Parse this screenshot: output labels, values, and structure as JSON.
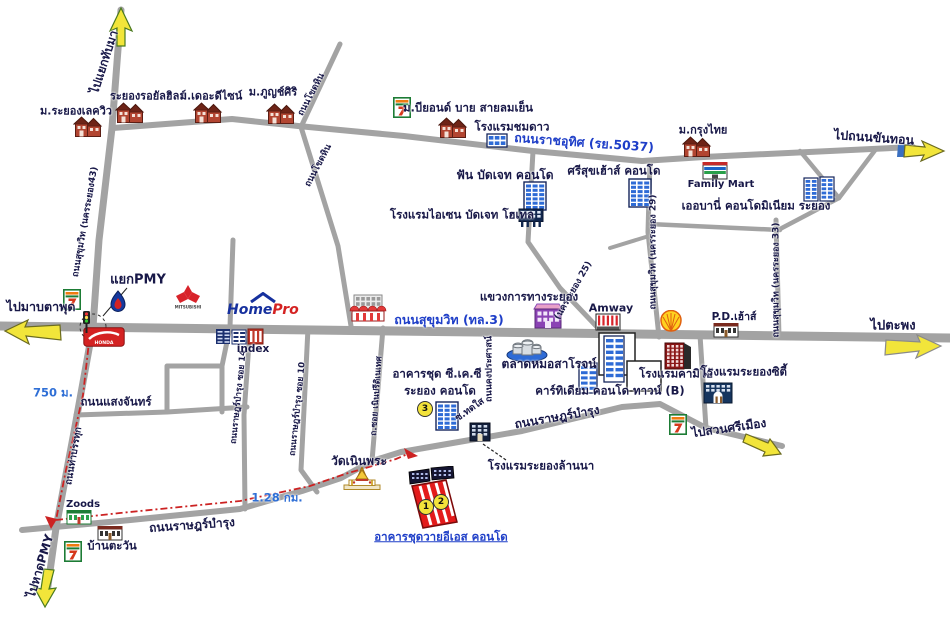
{
  "colors": {
    "dark": "#181848",
    "blue": "#1e3ec8",
    "dist": "#2f6fd6",
    "road": "#a3a3a3",
    "route_red": "#cc2222",
    "arrow_yellow": "#f2e53a"
  },
  "map": {
    "homepro": {
      "home": "Home",
      "pro": "Pro"
    },
    "labels": [
      {
        "id": "to-thapma",
        "text": "ไปแยกทับมา",
        "x": 104,
        "y": 62,
        "rot": -72,
        "size": 12
      },
      {
        "id": "lakeview",
        "text": "ม.ระยองเลควิว",
        "x": 76,
        "y": 111,
        "size": 11
      },
      {
        "id": "royal-hills",
        "text": "ระยองรอยัลฮิลส์",
        "x": 148,
        "y": 96,
        "size": 11
      },
      {
        "id": "the-design",
        "text": "ม.เดอะดีไซน์",
        "x": 211,
        "y": 96,
        "size": 11
      },
      {
        "id": "phuchsiri",
        "text": "ม.ภูญช์ศิริ",
        "x": 273,
        "y": 92,
        "size": 11
      },
      {
        "id": "khothin-upper",
        "text": "ถนนโขดหิน",
        "x": 312,
        "y": 95,
        "rot": -62,
        "size": 9
      },
      {
        "id": "khothin-lower",
        "text": "ถนนโขดหิน",
        "x": 319,
        "y": 166,
        "rot": -62,
        "size": 9
      },
      {
        "id": "beyond",
        "text": "ม.บียอนด์ บาย สายลมเย็น",
        "x": 468,
        "y": 108,
        "size": 11.5
      },
      {
        "id": "chomdao",
        "text": "โรงแรมชมดาว",
        "x": 512,
        "y": 127,
        "size": 11.5
      },
      {
        "id": "ratcha-uthit",
        "text": "ถนนราชอุทิศ (รย.5037)",
        "x": 584,
        "y": 143,
        "rot": 4,
        "size": 12.5,
        "color": "blue"
      },
      {
        "id": "fun-budget",
        "text": "ฟัน บัดเจท คอนโด",
        "x": 505,
        "y": 175,
        "size": 12
      },
      {
        "id": "aisen",
        "text": "โรงแรมไอเซน บัดเจท โฮเทล",
        "x": 462,
        "y": 215,
        "size": 11.5
      },
      {
        "id": "srisuk",
        "text": "ศรีสุขเฮ้าส์ คอนโด",
        "x": 614,
        "y": 171,
        "size": 11.5
      },
      {
        "id": "krungthai",
        "text": "ม.กรุงไทย",
        "x": 703,
        "y": 130,
        "size": 11
      },
      {
        "id": "familymart",
        "text": "Family Mart",
        "x": 721,
        "y": 185,
        "size": 10
      },
      {
        "id": "urbani",
        "text": "เออบานี่ คอนโดมิเนียม ระยอง",
        "x": 756,
        "y": 206,
        "size": 11.5
      },
      {
        "id": "to-khanthon",
        "text": "ไปถนนขันทอน",
        "x": 874,
        "y": 138,
        "rot": 4,
        "size": 12.5
      },
      {
        "id": "nakhon29",
        "text": "ถนนสุขุมวิท (นครระยอง 29)",
        "x": 654,
        "y": 252,
        "rot": -90,
        "size": 9
      },
      {
        "id": "nakhon33",
        "text": "ถนนสุขุมวิท (นครระยอง 33)",
        "x": 777,
        "y": 280,
        "rot": -90,
        "size": 9
      },
      {
        "id": "nakhon43",
        "text": "ถนนสุขุมวิท (นครระยอง43)",
        "x": 86,
        "y": 222,
        "rot": -80,
        "size": 9
      },
      {
        "id": "nakhon25",
        "text": "(นครระยอง 25)",
        "x": 574,
        "y": 291,
        "rot": -60,
        "size": 9
      },
      {
        "id": "yaek-pmy",
        "text": "แยกPMY",
        "x": 138,
        "y": 280,
        "size": 13
      },
      {
        "id": "to-maptaphut",
        "text": "ไปมาบตาพุด",
        "x": 41,
        "y": 307,
        "size": 12.5
      },
      {
        "id": "to-taphong",
        "text": "ไปตะพง",
        "x": 893,
        "y": 326,
        "size": 13
      },
      {
        "id": "sukhumvit",
        "text": "ถนนสุขุมวิท (ทล.3)",
        "x": 449,
        "y": 320,
        "color": "blue",
        "size": 12.5
      },
      {
        "id": "khwaeng",
        "text": "แขวงการทางระยอง",
        "x": 529,
        "y": 297,
        "size": 11.5
      },
      {
        "id": "amway",
        "text": "Amway",
        "x": 611,
        "y": 308,
        "size": 11
      },
      {
        "id": "pd-house",
        "text": "P.D.เฮ้าส์",
        "x": 734,
        "y": 317,
        "size": 10.5
      },
      {
        "id": "khong-prasat",
        "text": "ถนนคงประศาสน์",
        "x": 490,
        "y": 369,
        "rot": -90,
        "size": 9
      },
      {
        "id": "soi14",
        "text": "ถนนราษฎร์บำรุง ซอย 14",
        "x": 239,
        "y": 397,
        "rot": -84,
        "size": 8.5
      },
      {
        "id": "soi10",
        "text": "ถนนราษฎร์บำรุง ซอย 10",
        "x": 298,
        "y": 409,
        "rot": -84,
        "size": 8.5
      },
      {
        "id": "soi-noen",
        "text": "ถ.ซอย เนินปรีดิเนเทศ",
        "x": 377,
        "y": 396,
        "rot": -86,
        "size": 8.5
      },
      {
        "id": "saengchan",
        "text": "ถนนแสงจันทร์",
        "x": 116,
        "y": 402,
        "size": 11.5
      },
      {
        "id": "d750",
        "text": "750 ม.",
        "x": 53,
        "y": 393,
        "color": "dist",
        "size": 11.5
      },
      {
        "id": "thabanthuk",
        "text": "ถนนท่าบรรทุก",
        "x": 74,
        "y": 456,
        "rot": -80,
        "size": 9.5
      },
      {
        "id": "ckc1",
        "text": "อาคารชุด ซี.เค.ซี",
        "x": 437,
        "y": 374,
        "size": 11.5
      },
      {
        "id": "ckc2",
        "text": "ระยอง คอนโด",
        "x": 440,
        "y": 391,
        "size": 11.5
      },
      {
        "id": "talat",
        "text": "ตลาดหมอสาโรจน์",
        "x": 549,
        "y": 364,
        "size": 12
      },
      {
        "id": "cartidium",
        "text": "คาร์ทิเดียม คอนโด ทาวน์ (B)",
        "x": 610,
        "y": 391,
        "size": 11.5
      },
      {
        "id": "kameo",
        "text": "โรงแรมคามิโอ้",
        "x": 676,
        "y": 374,
        "size": 11.5
      },
      {
        "id": "rayong-city",
        "text": "โรงแรมระยองซิตี้",
        "x": 744,
        "y": 372,
        "size": 11.5
      },
      {
        "id": "to-suansri",
        "text": "ไปสวนศรีเมือง",
        "x": 729,
        "y": 428,
        "rot": -8,
        "size": 12
      },
      {
        "id": "ratbamrung-u",
        "text": "ถนนราษฎร์บำรุง",
        "x": 557,
        "y": 417,
        "rot": -10,
        "size": 12
      },
      {
        "id": "soi-thodsai",
        "text": "ซ.ทดใส",
        "x": 470,
        "y": 410,
        "rot": -35,
        "size": 9.5
      },
      {
        "id": "lanna",
        "text": "โรงแรมระยองล้านนา",
        "x": 541,
        "y": 466,
        "size": 11.5
      },
      {
        "id": "wat",
        "text": "วัดเนินพระ",
        "x": 359,
        "y": 461,
        "size": 12
      },
      {
        "id": "d128",
        "text": "1.28 กม.",
        "x": 277,
        "y": 498,
        "color": "dist",
        "size": 11.5
      },
      {
        "id": "ratbamrung-l",
        "text": "ถนนราษฎร์บำรุง",
        "x": 192,
        "y": 525,
        "rot": -4,
        "size": 12
      },
      {
        "id": "zoods",
        "text": "Zoods",
        "x": 83,
        "y": 505,
        "size": 10
      },
      {
        "id": "baantawan",
        "text": "บ้านตะวัน",
        "x": 112,
        "y": 546,
        "size": 11.5
      },
      {
        "id": "to-hat-pmy",
        "text": "ไปหาดPMY",
        "x": 40,
        "y": 566,
        "rot": -73,
        "size": 12
      },
      {
        "id": "yes-condo",
        "text": "อาคารชุดวายอีเอส คอนโด",
        "x": 441,
        "y": 537,
        "color": "blue",
        "underline": true,
        "size": 11.5
      },
      {
        "id": "index",
        "text": "index",
        "x": 253,
        "y": 349,
        "size": 10.5
      }
    ],
    "badges": [
      {
        "id": "point-3",
        "text": "3",
        "x": 425,
        "y": 409
      },
      {
        "id": "point-1",
        "text": "1",
        "x": 426,
        "y": 507
      },
      {
        "id": "point-2",
        "text": "2",
        "x": 441,
        "y": 502
      }
    ],
    "places": [
      {
        "id": "seven-eleven-top",
        "type": "seven",
        "x": 402,
        "y": 107
      },
      {
        "id": "seven-eleven-left",
        "type": "seven",
        "x": 72,
        "y": 299
      },
      {
        "id": "seven-eleven-suansri",
        "type": "seven",
        "x": 678,
        "y": 424
      },
      {
        "id": "seven-eleven-south",
        "type": "seven",
        "x": 73,
        "y": 551
      },
      {
        "id": "lakeview-house",
        "type": "house",
        "x": 88,
        "y": 126
      },
      {
        "id": "royalhills-house",
        "type": "house",
        "x": 130,
        "y": 112
      },
      {
        "id": "design-house",
        "type": "house",
        "x": 208,
        "y": 112
      },
      {
        "id": "phuchsiri-house",
        "type": "house",
        "x": 281,
        "y": 113
      },
      {
        "id": "beyond-house",
        "type": "house",
        "x": 453,
        "y": 127
      },
      {
        "id": "chomdao-building",
        "type": "condoLow",
        "x": 497,
        "y": 140
      },
      {
        "id": "fun-condo-building",
        "type": "condo",
        "x": 535,
        "y": 196
      },
      {
        "id": "aisen-building",
        "type": "hotelDark",
        "x": 531,
        "y": 218
      },
      {
        "id": "srisuk-building",
        "type": "condo",
        "x": 640,
        "y": 193
      },
      {
        "id": "familymart-building",
        "type": "familymart",
        "x": 715,
        "y": 170
      },
      {
        "id": "krungthai-house",
        "type": "house",
        "x": 697,
        "y": 146
      },
      {
        "id": "urbani-building",
        "type": "condoTwin",
        "x": 819,
        "y": 189
      },
      {
        "id": "ptt-logo",
        "type": "ptt",
        "x": 118,
        "y": 301
      },
      {
        "id": "mitsubishi-logo",
        "type": "mitsubishi",
        "x": 188,
        "y": 297
      },
      {
        "id": "honda-logo",
        "type": "honda",
        "x": 104,
        "y": 337
      },
      {
        "id": "traffic-light",
        "type": "traffic",
        "x": 86,
        "y": 322
      },
      {
        "id": "homepro-logo",
        "type": "homepro",
        "x": 258,
        "y": 306
      },
      {
        "id": "index-building",
        "type": "index",
        "x": 240,
        "y": 336
      },
      {
        "id": "laemthong-building",
        "type": "mall",
        "x": 368,
        "y": 308
      },
      {
        "id": "khwaeng-building",
        "type": "purple",
        "x": 548,
        "y": 316
      },
      {
        "id": "amway-building",
        "type": "amway",
        "x": 608,
        "y": 322
      },
      {
        "id": "shell-logo",
        "type": "shell",
        "x": 671,
        "y": 321
      },
      {
        "id": "pdhouse-building",
        "type": "shophouse",
        "x": 726,
        "y": 330
      },
      {
        "id": "market-building",
        "type": "market",
        "x": 527,
        "y": 348
      },
      {
        "id": "cartidium-building",
        "type": "cartidium",
        "x": 617,
        "y": 363
      },
      {
        "id": "kameo-building",
        "type": "kameo",
        "x": 678,
        "y": 355
      },
      {
        "id": "rayongcity-building",
        "type": "cityhotel",
        "x": 718,
        "y": 393
      },
      {
        "id": "ckc-building",
        "type": "condo",
        "x": 447,
        "y": 416
      },
      {
        "id": "lanna-building",
        "type": "hotelDarkSm",
        "x": 480,
        "y": 432
      },
      {
        "id": "wat-building",
        "type": "temple",
        "x": 362,
        "y": 479
      },
      {
        "id": "zoods-building",
        "type": "shopGreen",
        "x": 79,
        "y": 517
      },
      {
        "id": "tawan-building",
        "type": "shophouse",
        "x": 110,
        "y": 533
      },
      {
        "id": "yes-building",
        "type": "yes",
        "x": 432,
        "y": 498
      }
    ]
  }
}
